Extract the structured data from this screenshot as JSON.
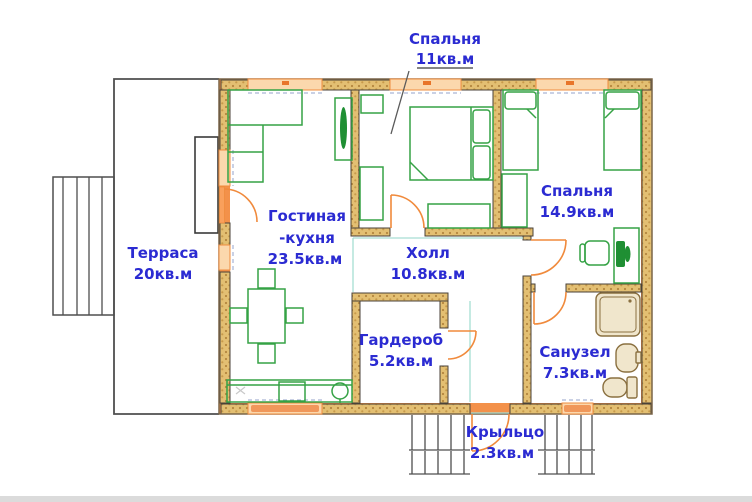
{
  "rooms": [
    {
      "name": "Спальня",
      "area": "11кв.м"
    },
    {
      "name": "Спальня",
      "area": "14.9кв.м"
    },
    {
      "name": "Терраса",
      "area": "20кв.м"
    },
    {
      "name": "Гостиная",
      "name2": "-кухня",
      "area": "23.5кв.м"
    },
    {
      "name": "Холл",
      "area": "10.8кв.м"
    },
    {
      "name": "Гардероб",
      "area": "5.2кв.м"
    },
    {
      "name": "Санузел",
      "area": "7.3кв.м"
    },
    {
      "name": "Крыльцо",
      "area": "2.3кв.м"
    }
  ],
  "colors": {
    "label_blue": "#2b2bd2",
    "wall_orange": "#f3914a",
    "wall_hatch": "#e3bf72",
    "furniture_green": "#35a245",
    "fixture_tan": "#8a7040",
    "opening_teal": "#a6ded3"
  }
}
